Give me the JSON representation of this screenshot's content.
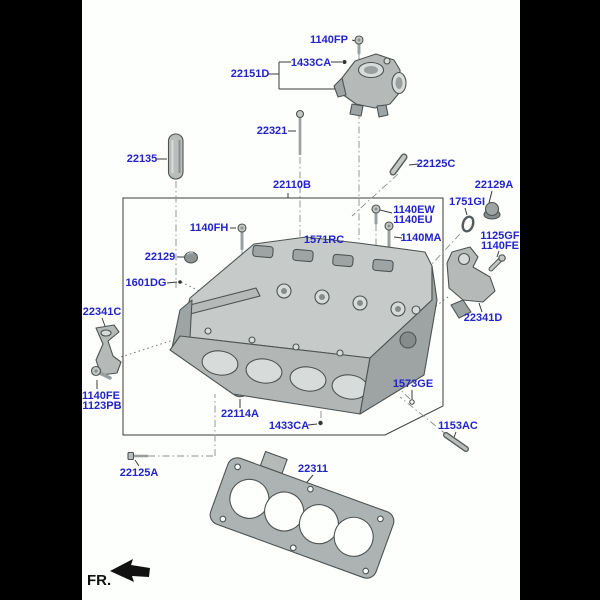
{
  "diagram": {
    "type": "exploded-parts-diagram",
    "subject": "cylinder-head-assembly",
    "fr_label": "FR.",
    "colors": {
      "label": "#2323c8",
      "leader_line": "#3a3a3a",
      "centerline": "#8b8b8b",
      "part_fill": "#b9bdbc",
      "part_stroke": "#4e5453",
      "canvas": "#fdfffd",
      "matte": "#000000"
    },
    "callouts": [
      {
        "id": "1140fp",
        "text": "1140FP",
        "x": 329,
        "y": 40
      },
      {
        "id": "1433ca-top",
        "text": "1433CA",
        "x": 311,
        "y": 63
      },
      {
        "id": "22151d",
        "text": "22151D",
        "x": 250,
        "y": 74
      },
      {
        "id": "22321",
        "text": "22321",
        "x": 272,
        "y": 131
      },
      {
        "id": "22135",
        "text": "22135",
        "x": 142,
        "y": 159
      },
      {
        "id": "22110b",
        "text": "22110B",
        "x": 292,
        "y": 185
      },
      {
        "id": "22125c",
        "text": "22125C",
        "x": 436,
        "y": 164
      },
      {
        "id": "22129a",
        "text": "22129A",
        "x": 494,
        "y": 185
      },
      {
        "id": "1751gi",
        "text": "1751GI",
        "x": 467,
        "y": 202
      },
      {
        "id": "1140ew",
        "text": "1140EW",
        "x": 414,
        "y": 210
      },
      {
        "id": "1140eu",
        "text": "1140EU",
        "x": 413,
        "y": 220
      },
      {
        "id": "1140ma",
        "text": "1140MA",
        "x": 421,
        "y": 238
      },
      {
        "id": "1125gf",
        "text": "1125GF",
        "x": 500,
        "y": 236
      },
      {
        "id": "1140fe-right",
        "text": "1140FE",
        "x": 500,
        "y": 246
      },
      {
        "id": "1140fh",
        "text": "1140FH",
        "x": 209,
        "y": 228
      },
      {
        "id": "1571rc",
        "text": "1571RC",
        "x": 324,
        "y": 240
      },
      {
        "id": "22129",
        "text": "22129",
        "x": 160,
        "y": 257
      },
      {
        "id": "1601dg",
        "text": "1601DG",
        "x": 146,
        "y": 283
      },
      {
        "id": "22341c",
        "text": "22341C",
        "x": 102,
        "y": 312
      },
      {
        "id": "22341d",
        "text": "22341D",
        "x": 483,
        "y": 318
      },
      {
        "id": "1140fe-left",
        "text": "1140FE",
        "x": 101,
        "y": 396
      },
      {
        "id": "1123pb",
        "text": "1123PB",
        "x": 102,
        "y": 406
      },
      {
        "id": "1573ge",
        "text": "1573GE",
        "x": 413,
        "y": 384
      },
      {
        "id": "22114a",
        "text": "22114A",
        "x": 240,
        "y": 414
      },
      {
        "id": "1433ca-bottom",
        "text": "1433CA",
        "x": 289,
        "y": 426
      },
      {
        "id": "1153ac",
        "text": "1153AC",
        "x": 458,
        "y": 426
      },
      {
        "id": "22125a",
        "text": "22125A",
        "x": 139,
        "y": 473
      },
      {
        "id": "22311",
        "text": "22311",
        "x": 313,
        "y": 469
      }
    ]
  }
}
